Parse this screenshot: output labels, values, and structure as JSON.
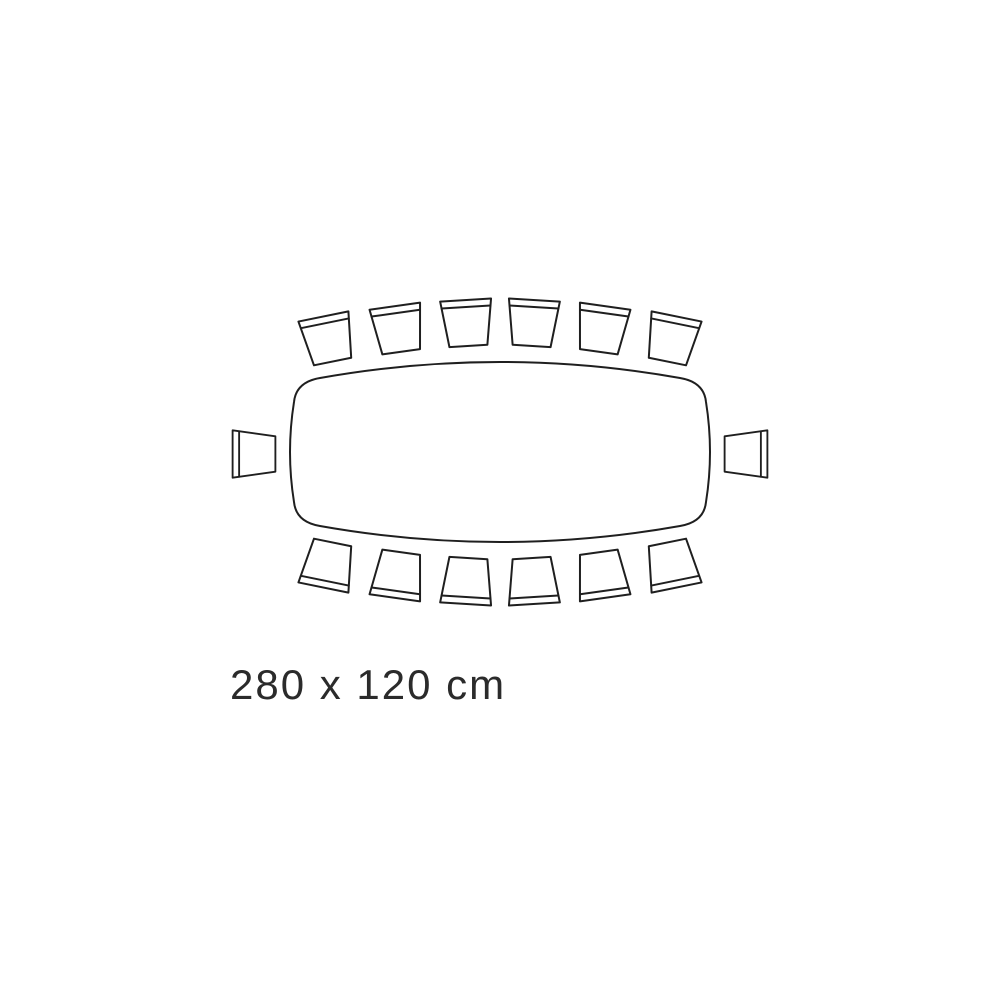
{
  "page": {
    "background": "#ffffff"
  },
  "colors": {
    "line": "#1f1f1f",
    "text": "#2b2b2b",
    "background": "#ffffff",
    "shape_fill": "#ffffff"
  },
  "diagram": {
    "name": "dining-table-seating-top-view",
    "label": "280 x 120 cm",
    "table": {
      "shape": "rounded-rectangle-bowed-edges",
      "width_cm": 280,
      "depth_cm": 120
    },
    "seats": {
      "total": 14,
      "top_row": 6,
      "bottom_row": 6,
      "left_end": 1,
      "right_end": 1
    },
    "chairs": [
      {
        "id": "top-1",
        "x": 328,
        "y": 339,
        "rotation": -11.5,
        "scale": 1
      },
      {
        "id": "top-2",
        "x": 398,
        "y": 329,
        "rotation": -8,
        "scale": 1
      },
      {
        "id": "top-3",
        "x": 467,
        "y": 323,
        "rotation": -3.5,
        "scale": 1
      },
      {
        "id": "top-4",
        "x": 533,
        "y": 323,
        "rotation": 3.5,
        "scale": 1
      },
      {
        "id": "top-5",
        "x": 602,
        "y": 329,
        "rotation": 8,
        "scale": 1
      },
      {
        "id": "top-6",
        "x": 672,
        "y": 339,
        "rotation": 11.5,
        "scale": 1
      },
      {
        "id": "bottom-1",
        "x": 328,
        "y": 565,
        "rotation": 191.5,
        "scale": 1
      },
      {
        "id": "bottom-2",
        "x": 398,
        "y": 575,
        "rotation": 188,
        "scale": 1
      },
      {
        "id": "bottom-3",
        "x": 467,
        "y": 581,
        "rotation": 183.5,
        "scale": 1
      },
      {
        "id": "bottom-4",
        "x": 533,
        "y": 581,
        "rotation": 176.5,
        "scale": 1
      },
      {
        "id": "bottom-5",
        "x": 602,
        "y": 575,
        "rotation": 172,
        "scale": 1
      },
      {
        "id": "bottom-6",
        "x": 672,
        "y": 565,
        "rotation": 168.5,
        "scale": 1
      },
      {
        "id": "left-end",
        "x": 254,
        "y": 454,
        "rotation": -90,
        "scale": 0.93
      },
      {
        "id": "right-end",
        "x": 746,
        "y": 454,
        "rotation": 90,
        "scale": 0.93
      }
    ]
  }
}
